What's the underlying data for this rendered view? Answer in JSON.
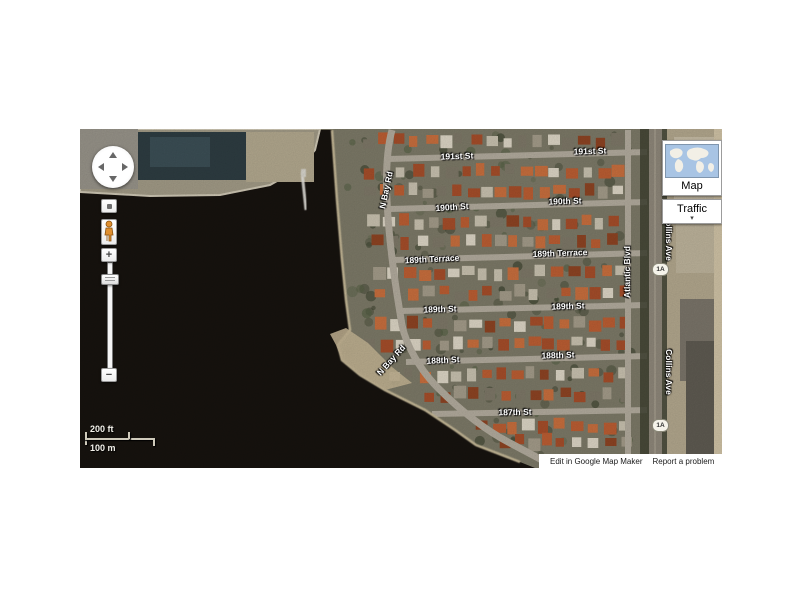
{
  "controls": {
    "zoom_in_label": "+",
    "zoom_out_label": "−"
  },
  "layer_widget": {
    "map_label": "Map",
    "traffic_label": "Traffic",
    "dropdown_arrow": "▾"
  },
  "scale": {
    "imperial_label": "200 ft",
    "metric_label": "100 m"
  },
  "footer": {
    "edit_label": "Edit in Google Map Maker",
    "report_label": "Report a problem",
    "clipped_text": "K"
  },
  "route_shield_text": "1A",
  "street_labels": [
    {
      "text": "191st St",
      "x": 377,
      "y": 27,
      "rot": -2
    },
    {
      "text": "191st St",
      "x": 510,
      "y": 22,
      "rot": -2
    },
    {
      "text": "190th St",
      "x": 372,
      "y": 78,
      "rot": -4
    },
    {
      "text": "190th St",
      "x": 485,
      "y": 72,
      "rot": -2
    },
    {
      "text": "189th Terrace",
      "x": 352,
      "y": 130,
      "rot": -3
    },
    {
      "text": "189th Terrace",
      "x": 480,
      "y": 124,
      "rot": -2
    },
    {
      "text": "189th St",
      "x": 360,
      "y": 180,
      "rot": -2
    },
    {
      "text": "189th St",
      "x": 488,
      "y": 177,
      "rot": -2
    },
    {
      "text": "188th St",
      "x": 363,
      "y": 231,
      "rot": -3
    },
    {
      "text": "188th St",
      "x": 478,
      "y": 226,
      "rot": -2
    },
    {
      "text": "187th St",
      "x": 435,
      "y": 283,
      "rot": -1
    },
    {
      "text": "N Bay Rd",
      "x": 306,
      "y": 61,
      "rot": -78
    },
    {
      "text": "N Bay Rd",
      "x": 311,
      "y": 231,
      "rot": -48
    },
    {
      "text": "Atlantic Blvd",
      "x": 547,
      "y": 143,
      "rot": -90
    },
    {
      "text": "Collins Ave",
      "x": 589,
      "y": 109,
      "rot": 90
    },
    {
      "text": "Collins Ave",
      "x": 589,
      "y": 243,
      "rot": 90
    }
  ],
  "route_shields": [
    {
      "x": 572,
      "y": 134
    },
    {
      "x": 572,
      "y": 290
    }
  ],
  "colors": {
    "water": "#17130f",
    "land": "#7d7a68",
    "road": "#b3ac9e",
    "sand": "#c6b998",
    "trees": "#3a4130",
    "roof_orange": "#b1512f",
    "thumb_ocean": "#a8c4e4"
  }
}
